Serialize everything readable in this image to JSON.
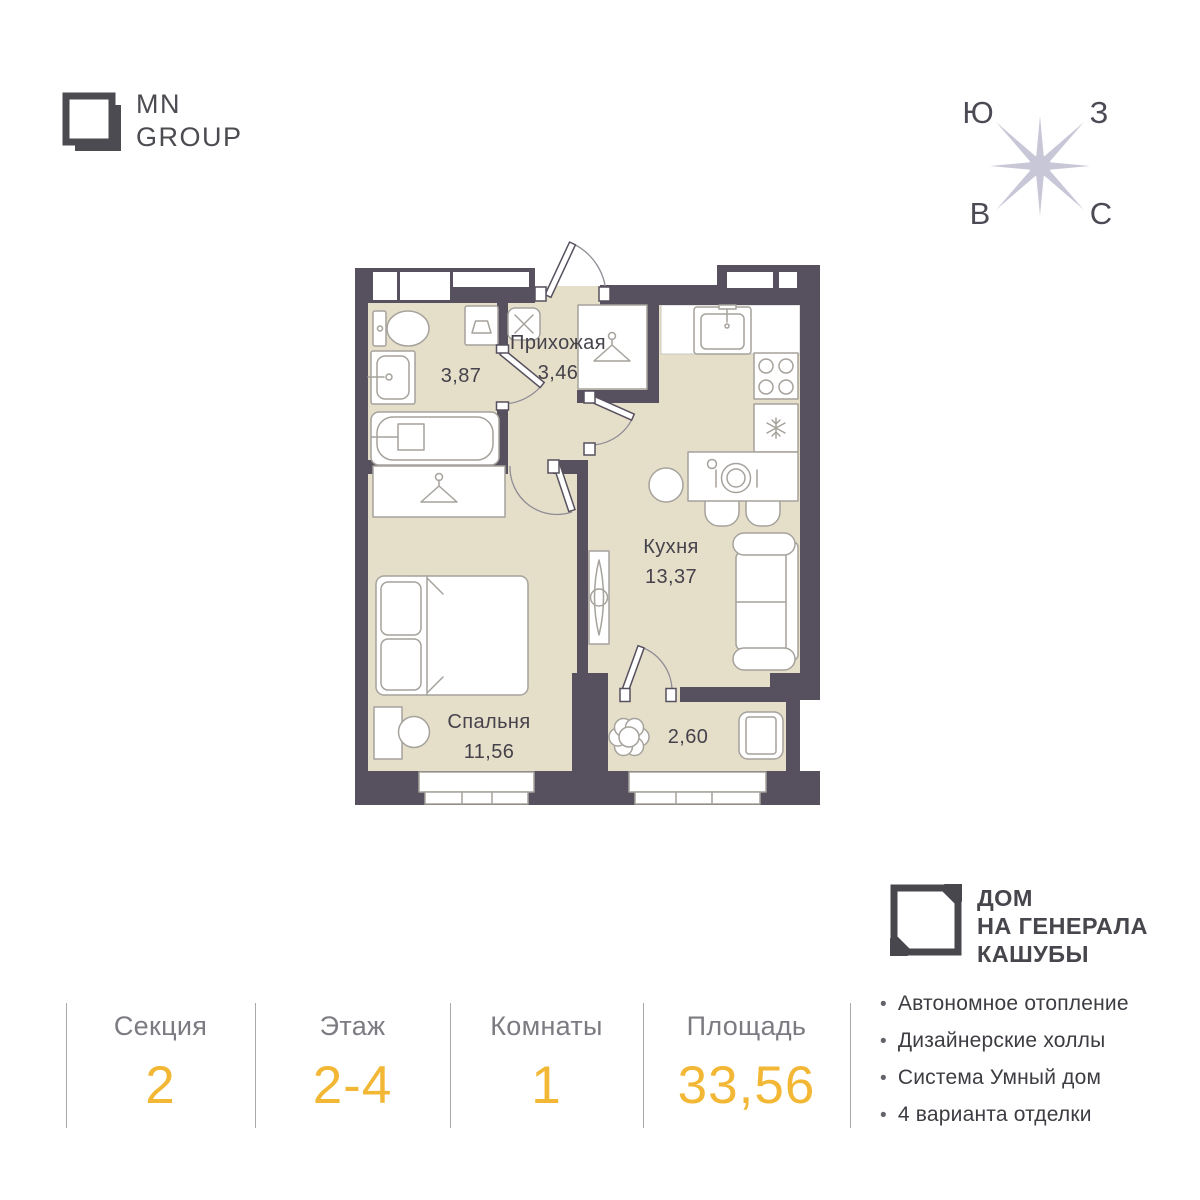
{
  "brand": {
    "line1": "MN",
    "line2": "GROUP"
  },
  "compass": {
    "top_left": "Ю",
    "top_right": "З",
    "bottom_left": "В",
    "bottom_right": "С"
  },
  "plan": {
    "bathroom_area": "3,87",
    "hallway_name": "Прихожая",
    "hallway_area": "3,46",
    "kitchen_name": "Кухня",
    "kitchen_area": "13,37",
    "bedroom_name": "Спальня",
    "bedroom_area": "11,56",
    "balcony_area": "2,60"
  },
  "project": {
    "line1": "ДОМ",
    "line2": "НА ГЕНЕРАЛА",
    "line3": "КАШУБЫ"
  },
  "summary": {
    "columns": [
      {
        "label": "Секция",
        "value": "2"
      },
      {
        "label": "Этаж",
        "value": "2-4"
      },
      {
        "label": "Комнаты",
        "value": "1"
      },
      {
        "label": "Площадь",
        "value": "33,56"
      }
    ]
  },
  "features": {
    "bullet": "•",
    "items": [
      "Автономное отопление",
      "Дизайнерские холлы",
      "Система Умный дом",
      "4 варианта отделки"
    ]
  },
  "colors": {
    "wall": "#57505e",
    "floor": "#e5dfca",
    "accent_gold": "#f2b734",
    "compass_star": "#c8c7d7",
    "text_dark": "#45424b",
    "text_gray": "#7b7b82"
  }
}
